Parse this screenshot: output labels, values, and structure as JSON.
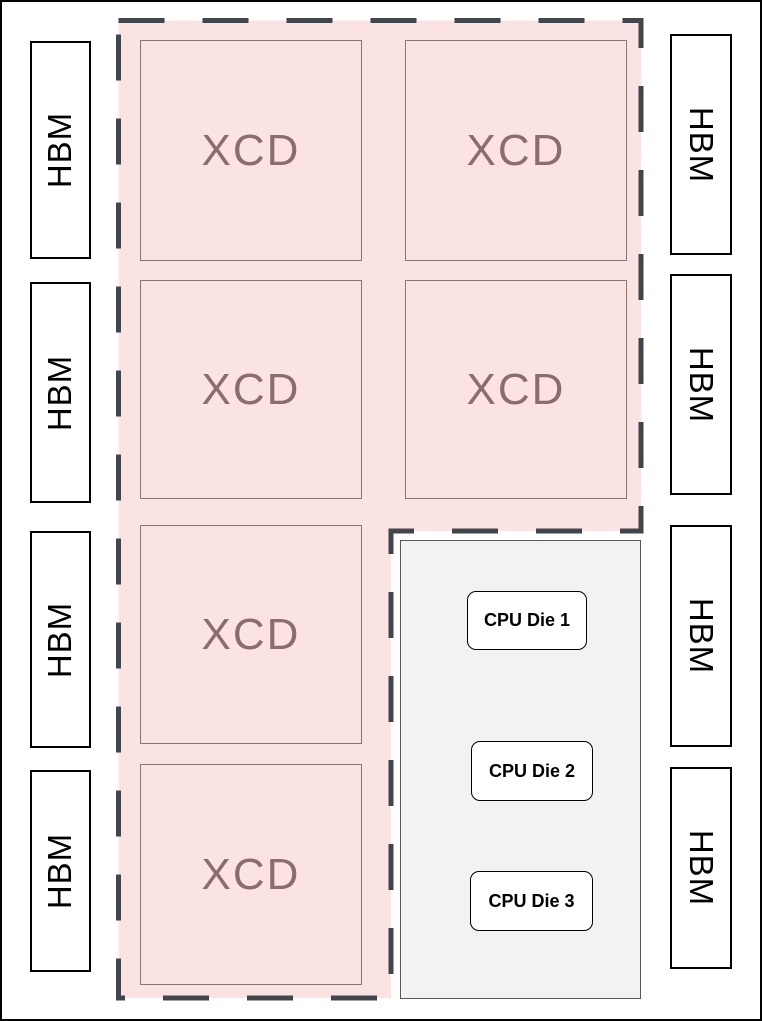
{
  "labels": {
    "hbm": "HBM",
    "xcd": "XCD"
  },
  "cpu_dies": [
    "CPU Die 1",
    "CPU Die 2",
    "CPU Die 3"
  ],
  "colors": {
    "gpu_region_fill": "#fce3e3",
    "gpu_region_dash": "#41454c",
    "xcd_text": "#8a6d6d",
    "xcd_border": "#8d7272",
    "cpu_region_fill": "#f2f2f2",
    "cpu_region_border": "#595959",
    "hbm_fill": "#ffffff",
    "hbm_border": "#000000",
    "cpu_die_fill": "#ffffff",
    "canvas_border": "#000000"
  }
}
